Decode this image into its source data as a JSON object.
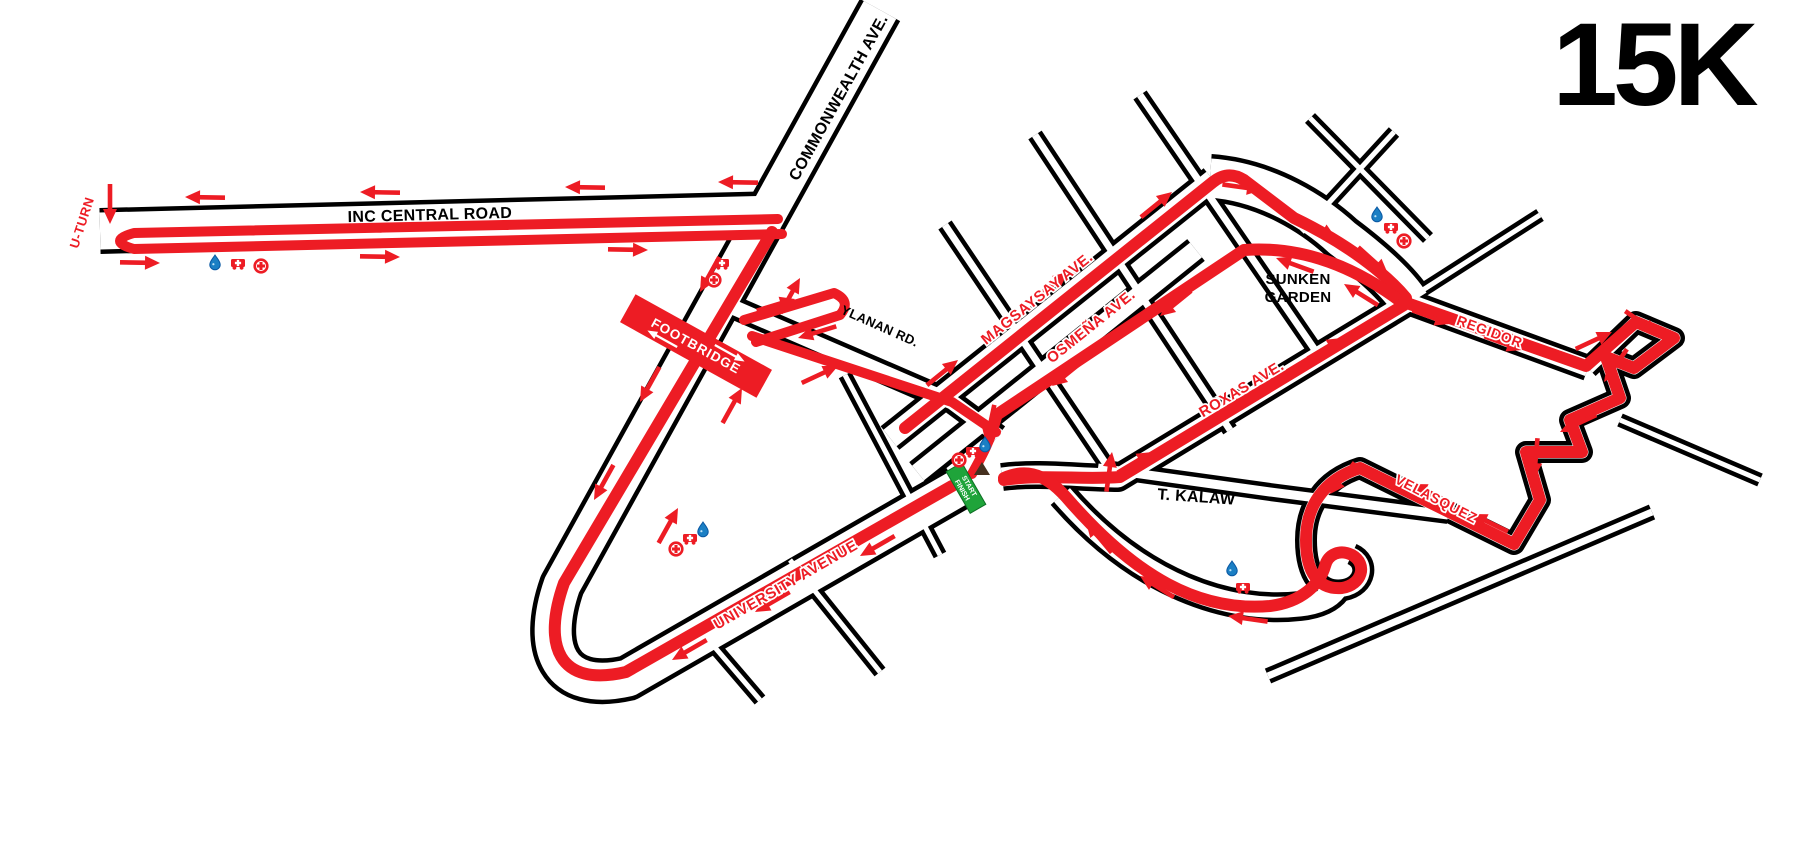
{
  "title": "15K",
  "colors": {
    "route": "#ed1c24",
    "road_casing": "#000000",
    "road_fill": "#ffffff",
    "water_icon": "#1b7fc4",
    "water_icon_dark": "#0a58a3",
    "start_banner": "#1fa43a",
    "footbridge_banner": "#ed1c24",
    "marker": "#45301f",
    "text_black": "#000000"
  },
  "labels": [
    {
      "id": "u-turn",
      "text": "U-TURN",
      "x": 86,
      "y": 224,
      "rot": -72,
      "cls": "lr",
      "size": 13
    },
    {
      "id": "inc-central-road",
      "text": "INC CENTRAL ROAD",
      "x": 430,
      "y": 220,
      "rot": -1.5,
      "cls": "lb",
      "size": 16
    },
    {
      "id": "commonwealth-ave",
      "text": "COMMONWEALTH AVE.",
      "x": 843,
      "y": 100,
      "rot": -61,
      "cls": "lb",
      "size": 16
    },
    {
      "id": "ylanan-rd",
      "text": "YLANAN RD.",
      "x": 878,
      "y": 330,
      "rot": 24,
      "cls": "lb",
      "size": 13
    },
    {
      "id": "magsaysay-ave",
      "text": "MAGSAYSAY AVE.",
      "x": 1040,
      "y": 302,
      "rot": -38.7,
      "cls": "lr",
      "size": 15
    },
    {
      "id": "osmena-ave",
      "text": "OSMEÑA AVE.",
      "x": 1094,
      "y": 330,
      "rot": -38.7,
      "cls": "lr",
      "size": 15
    },
    {
      "id": "roxas-ave",
      "text": "ROXAS AVE.",
      "x": 1244,
      "y": 393,
      "rot": -31,
      "cls": "lr",
      "size": 15
    },
    {
      "id": "sunken-garden-1",
      "text": "SUNKEN",
      "x": 1298,
      "y": 284,
      "rot": 0,
      "cls": "lb",
      "size": 15
    },
    {
      "id": "sunken-garden-2",
      "text": "GARDEN",
      "x": 1298,
      "y": 302,
      "rot": 0,
      "cls": "lb",
      "size": 15
    },
    {
      "id": "regidor",
      "text": "REGIDOR",
      "x": 1488,
      "y": 336,
      "rot": 20,
      "cls": "lr",
      "size": 14
    },
    {
      "id": "velasquez",
      "text": "VELASQUEZ",
      "x": 1434,
      "y": 503,
      "rot": 27,
      "cls": "lr",
      "size": 14
    },
    {
      "id": "t-kalaw",
      "text": "T. KALAW",
      "x": 1196,
      "y": 502,
      "rot": 4,
      "cls": "lb",
      "size": 16
    },
    {
      "id": "university-avenue",
      "text": "UNIVERSITY AVENUE",
      "x": 788,
      "y": 589,
      "rot": -30,
      "cls": "lr",
      "size": 15
    }
  ],
  "banners": {
    "footbridge": {
      "text": "FOOTBRIDGE",
      "x": 696,
      "y": 346,
      "rot": 29,
      "w": 156,
      "h": 32
    },
    "start_finish": {
      "line1": "START",
      "line2": "FINISH",
      "x": 966,
      "y": 488,
      "rot": 60,
      "w": 48,
      "h": 18
    }
  },
  "stations": [
    {
      "type": "water",
      "x": 215,
      "y": 262
    },
    {
      "type": "ambulance",
      "x": 238,
      "y": 264
    },
    {
      "type": "medical",
      "x": 261,
      "y": 266
    },
    {
      "type": "ambulance",
      "x": 722,
      "y": 264
    },
    {
      "type": "medical",
      "x": 714,
      "y": 280
    },
    {
      "type": "medical",
      "x": 676,
      "y": 549
    },
    {
      "type": "ambulance",
      "x": 690,
      "y": 539
    },
    {
      "type": "water",
      "x": 703,
      "y": 529
    },
    {
      "type": "medical",
      "x": 959,
      "y": 460
    },
    {
      "type": "ambulance",
      "x": 973,
      "y": 452
    },
    {
      "type": "water",
      "x": 985,
      "y": 444
    },
    {
      "type": "water",
      "x": 1377,
      "y": 214
    },
    {
      "type": "ambulance",
      "x": 1391,
      "y": 228
    },
    {
      "type": "medical",
      "x": 1404,
      "y": 241
    },
    {
      "type": "water",
      "x": 1232,
      "y": 568
    },
    {
      "type": "ambulance",
      "x": 1243,
      "y": 588
    }
  ],
  "start_marker": {
    "x": 982,
    "y": 471
  }
}
